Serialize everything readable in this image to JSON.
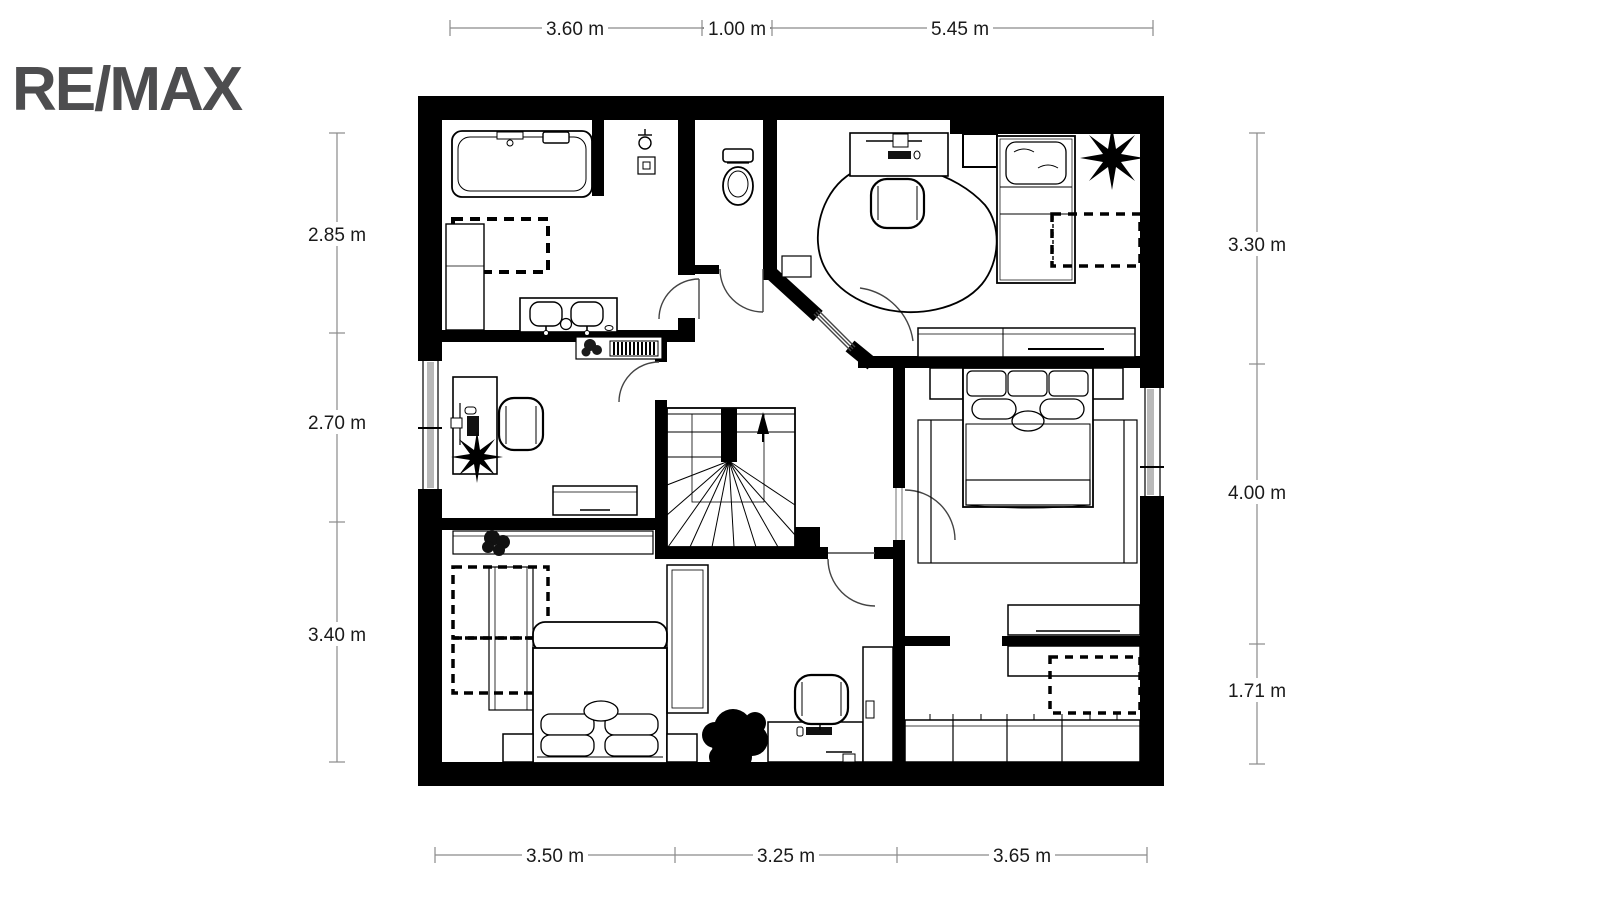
{
  "logo": {
    "text": "RE/MAX"
  },
  "dimensions": {
    "top": [
      {
        "label": "3.60 m"
      },
      {
        "label": "1.00 m"
      },
      {
        "label": "5.45 m"
      }
    ],
    "bottom": [
      {
        "label": "3.50 m"
      },
      {
        "label": "3.25 m"
      },
      {
        "label": "3.65 m"
      }
    ],
    "left": [
      {
        "label": "2.85 m"
      },
      {
        "label": "2.70 m"
      },
      {
        "label": "3.40 m"
      }
    ],
    "right": [
      {
        "label": "3.30 m"
      },
      {
        "label": "4.00 m"
      },
      {
        "label": "1.71 m"
      }
    ]
  },
  "colors": {
    "wall": "#000000",
    "logo": "#4d4d4f",
    "dimension_line": "#8a8a8a",
    "dimension_text": "#1a1a1a",
    "window_glass": "#b9b9b9",
    "background": "#ffffff"
  }
}
